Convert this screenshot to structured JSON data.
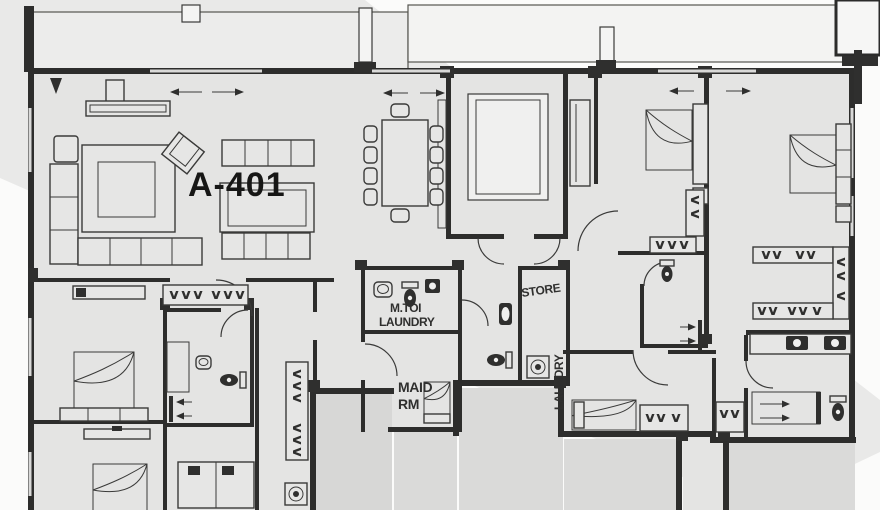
{
  "plan": {
    "unit_label": "A-401",
    "labels": {
      "maid_toilet": "M.TOI",
      "laundry": "LAUNDRY",
      "store": "STORE",
      "laundry_chute": "LAUNDRY",
      "maid_line1": "MAID",
      "maid_line2": "RM"
    },
    "colors": {
      "background": "#fbfbfa",
      "watermark": "#e9e9e8",
      "floor": "#e4e4e3",
      "outside_floor": "#dadad9",
      "core_shaft": "#d7d7d6",
      "wall": "#2d2d2c",
      "line": "#3a3a39",
      "unit_text": "#161615",
      "room_text": "#2f2f2e"
    },
    "legend_icons": [
      "bed",
      "sofa",
      "armchair",
      "rug",
      "tv-console",
      "dining-table",
      "dining-chair",
      "wardrobe-hanger-rail",
      "toilet",
      "sink",
      "washing-machine",
      "shower-arrow",
      "door-arc",
      "slide-door-arrow",
      "column",
      "balcony"
    ]
  }
}
